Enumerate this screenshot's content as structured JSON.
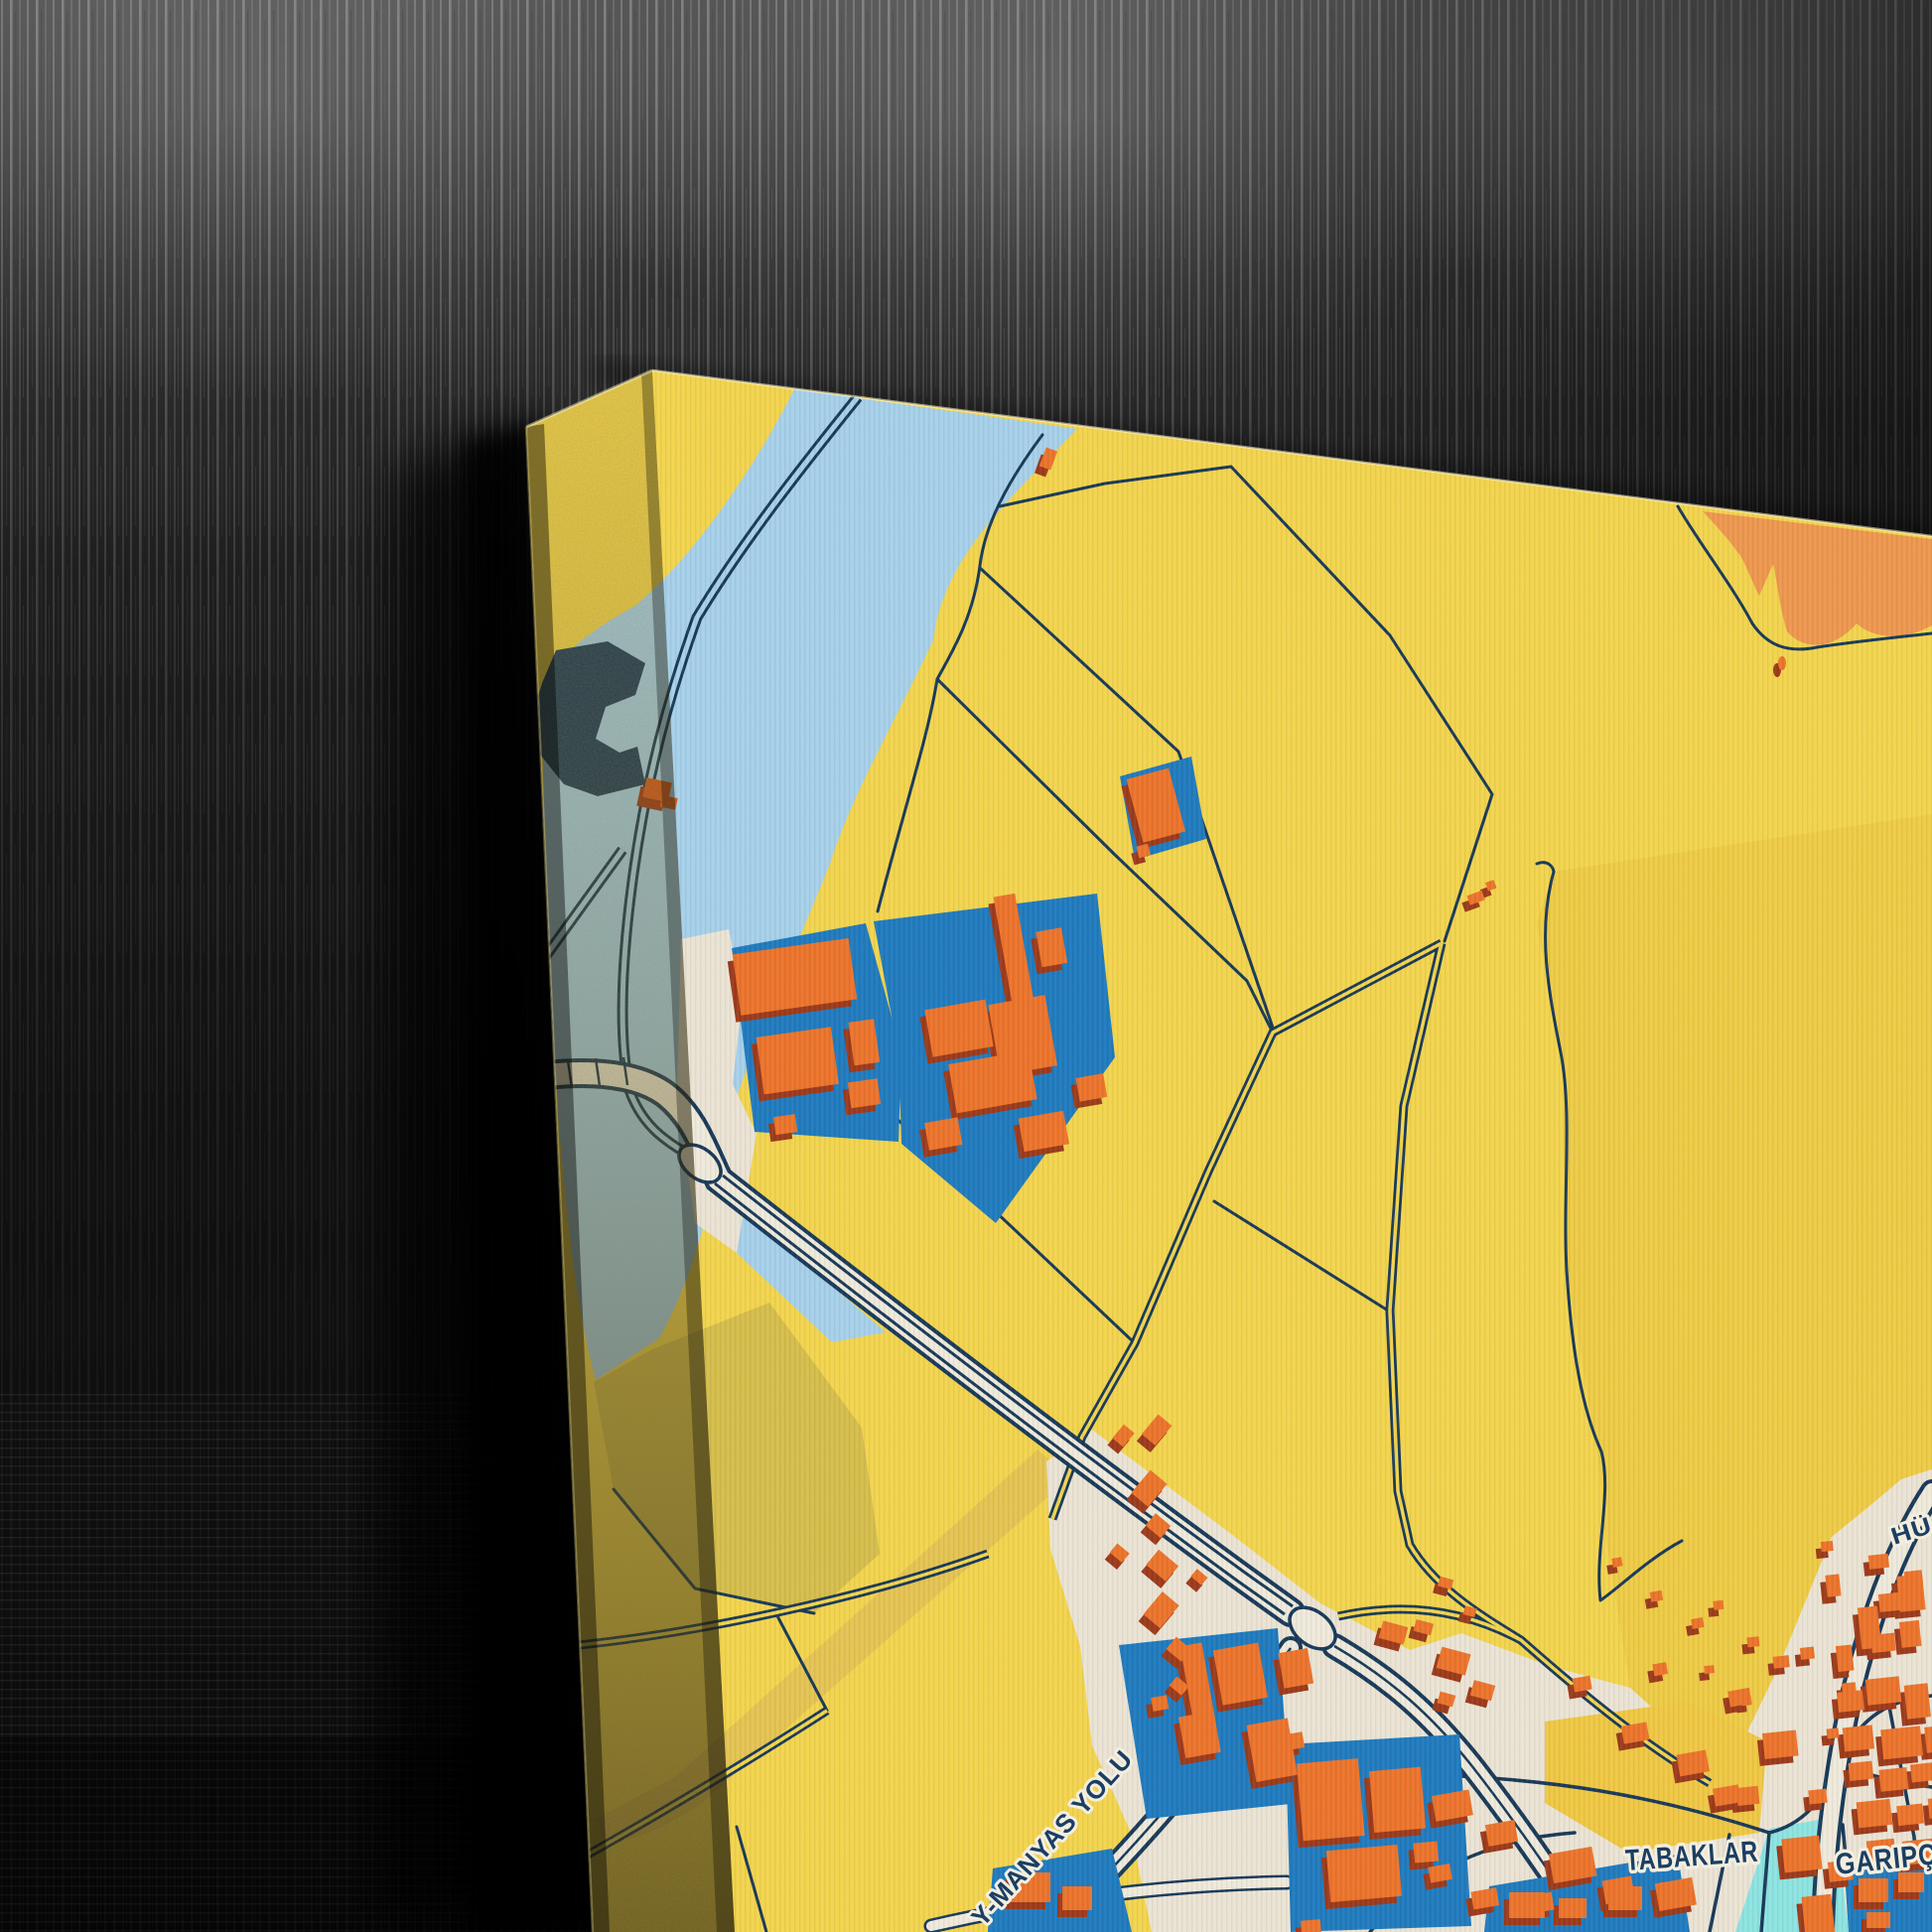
{
  "photo": {
    "alt": "Canvas map print hanging angled on a dark textured wall",
    "map_labels": {
      "district_left": "TABAKLAR",
      "district_right": "GARIPÇE",
      "road_diagonal": "Y-MANYAS YOLU",
      "road_partial": "HÜ"
    },
    "colors": {
      "land": "#F7D84F",
      "land_shade": "#F2CF47",
      "district_patch": "#F4CB45",
      "olive": "#D5BF4D",
      "tan_track": "#E9C754",
      "water": "#A9D4EF",
      "water_deep": "#1C3C5E",
      "channel": "#8FE8E6",
      "cream": "#EFE8D9",
      "road_fill": "#F3EEE0",
      "line": "#17395A",
      "parcel_blue": "#1F7CC2",
      "building": "#F0752C",
      "building_shadow": "#9E3A1B",
      "building_red": "#D85A20",
      "landuse_orange": "#F29A50",
      "label_fill": "#1B3E63",
      "label_halo": "#F3EEDF",
      "canvas_side": "#C9B44E",
      "wall": "#161616"
    }
  }
}
